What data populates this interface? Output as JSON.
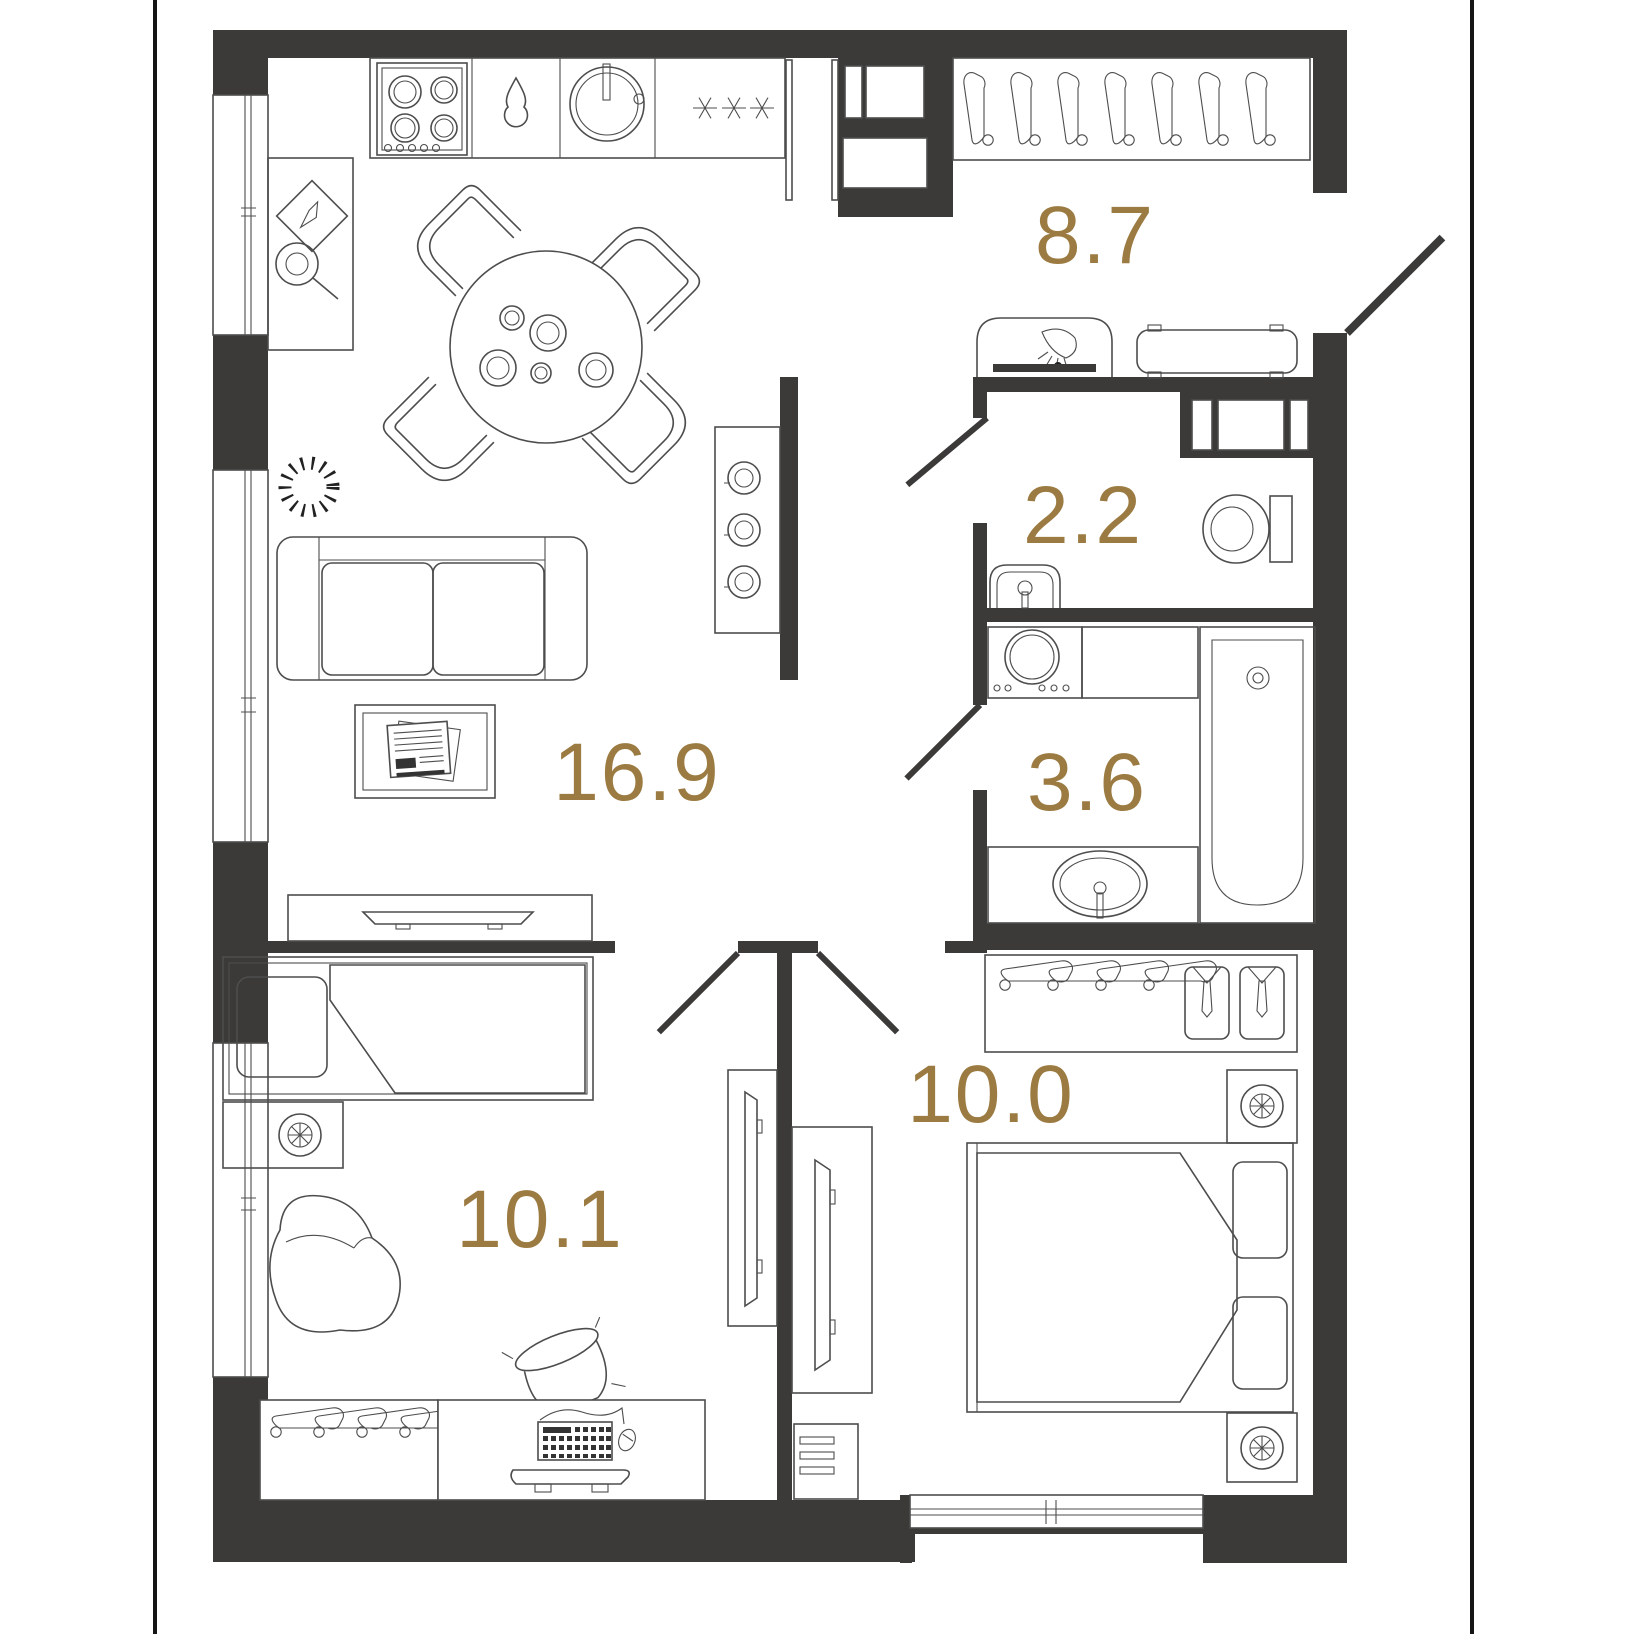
{
  "plan": {
    "title": "apartment-floor-plan",
    "rooms": [
      {
        "id": "living-kitchen",
        "area_label": "16.9"
      },
      {
        "id": "hallway",
        "area_label": "8.7"
      },
      {
        "id": "wc",
        "area_label": "2.2"
      },
      {
        "id": "bathroom",
        "area_label": "3.6"
      },
      {
        "id": "bedroom",
        "area_label": "10.0"
      },
      {
        "id": "kids-room",
        "area_label": "10.1"
      }
    ],
    "colors": {
      "wall": "#3b3a39",
      "line": "#4d4d4d",
      "label": "#9b7b41",
      "bg": "#ffffff",
      "border": "#151515"
    }
  }
}
